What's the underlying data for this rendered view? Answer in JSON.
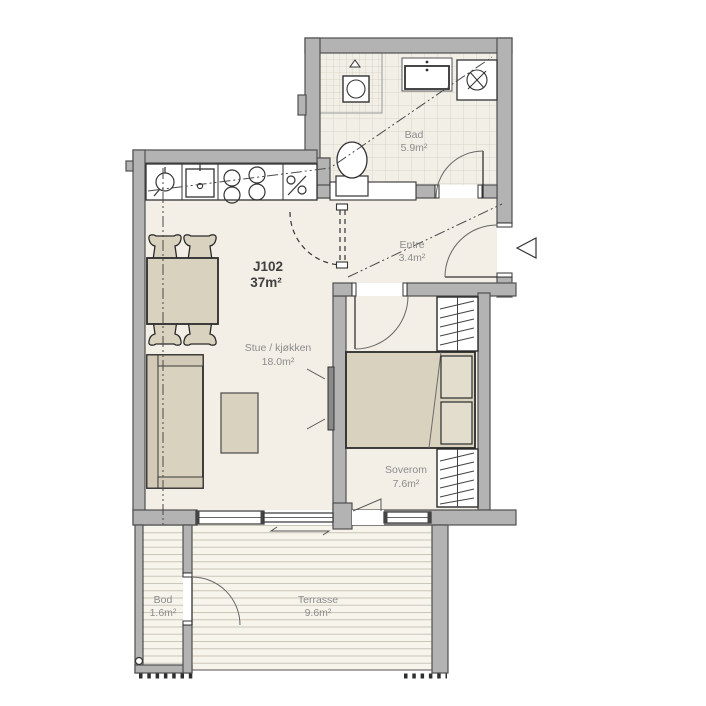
{
  "unit": {
    "id": "J102",
    "area": "37m²"
  },
  "rooms": {
    "bad": {
      "name": "Bad",
      "area": "5.9m²"
    },
    "entre": {
      "name": "Entre",
      "area": "3.4m²"
    },
    "stue": {
      "name": "Stue / kjøkken",
      "area": "18.0m²"
    },
    "soverom": {
      "name": "Soverom",
      "area": "7.6m²"
    },
    "bod": {
      "name": "Bod",
      "area": "1.6m²"
    },
    "terrasse": {
      "name": "Terrasse",
      "area": "9.6m²"
    }
  },
  "colors": {
    "wall": "#b3b3b3",
    "wall_outline": "#4f4f4f",
    "floor": "#f3efe6",
    "terrace_floor": "#f7f4ec",
    "furniture": "#d9d2bf",
    "furniture_light": "#e3ddcd",
    "label_text": "#8c8c8c",
    "unit_text": "#3f3f3f"
  }
}
